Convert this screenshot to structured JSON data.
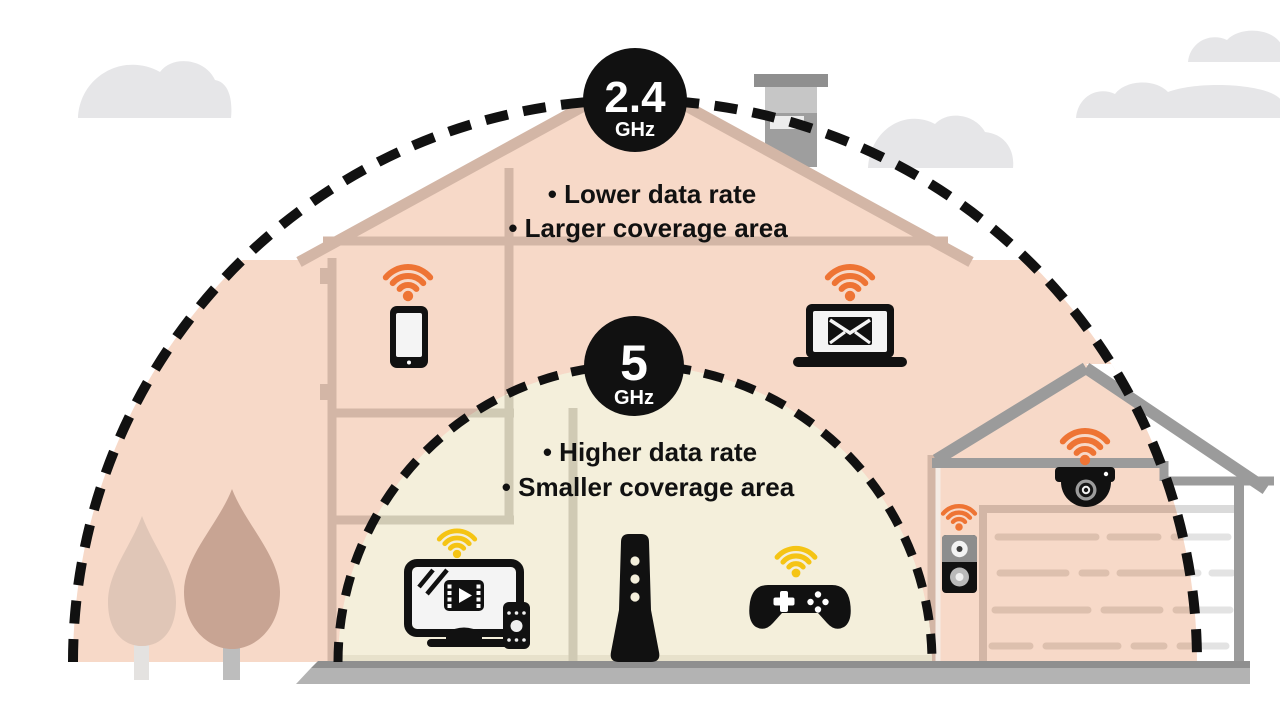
{
  "bands": {
    "b24": {
      "value": "2.4",
      "unit": "GHz",
      "bullet1": "•  Lower data rate",
      "bullet2": "•  Larger coverage area"
    },
    "b5": {
      "value": "5",
      "unit": "GHz",
      "bullet1": "•  Higher data rate",
      "bullet2": "•  Smaller coverage area"
    }
  },
  "devices": [
    {
      "icon": "smartphone-icon",
      "band": "2.4 GHz",
      "wifi_color": "orange"
    },
    {
      "icon": "laptop-email-icon",
      "band": "2.4 GHz",
      "wifi_color": "orange"
    },
    {
      "icon": "speaker-icon",
      "band": "2.4 GHz",
      "wifi_color": "orange"
    },
    {
      "icon": "security-camera-icon",
      "band": "2.4 GHz",
      "wifi_color": "orange"
    },
    {
      "icon": "smart-tv-remote-icon",
      "band": "5 GHz",
      "wifi_color": "yellow"
    },
    {
      "icon": "gamepad-icon",
      "band": "5 GHz",
      "wifi_color": "yellow"
    },
    {
      "icon": "wifi-router-icon",
      "band": "both",
      "wifi_color": "none"
    }
  ],
  "colors": {
    "ink": "#111111",
    "orange": "#ee7434",
    "yellow": "#f5c414",
    "pink": "#f7d9c8",
    "pink_line": "#d3b6a6",
    "door_line": "#ddc0ae",
    "cream": "#f4efdb",
    "cream_line": "#d0cab4",
    "structure": "#9b9b9b",
    "ground": "#b3b3b3",
    "ground_dark": "#8f8f8f",
    "cloud": "#e6e6e8",
    "tree_dark": "#c8a493",
    "tree_light": "#e0c6b7",
    "screen": "#f4f4f4"
  }
}
